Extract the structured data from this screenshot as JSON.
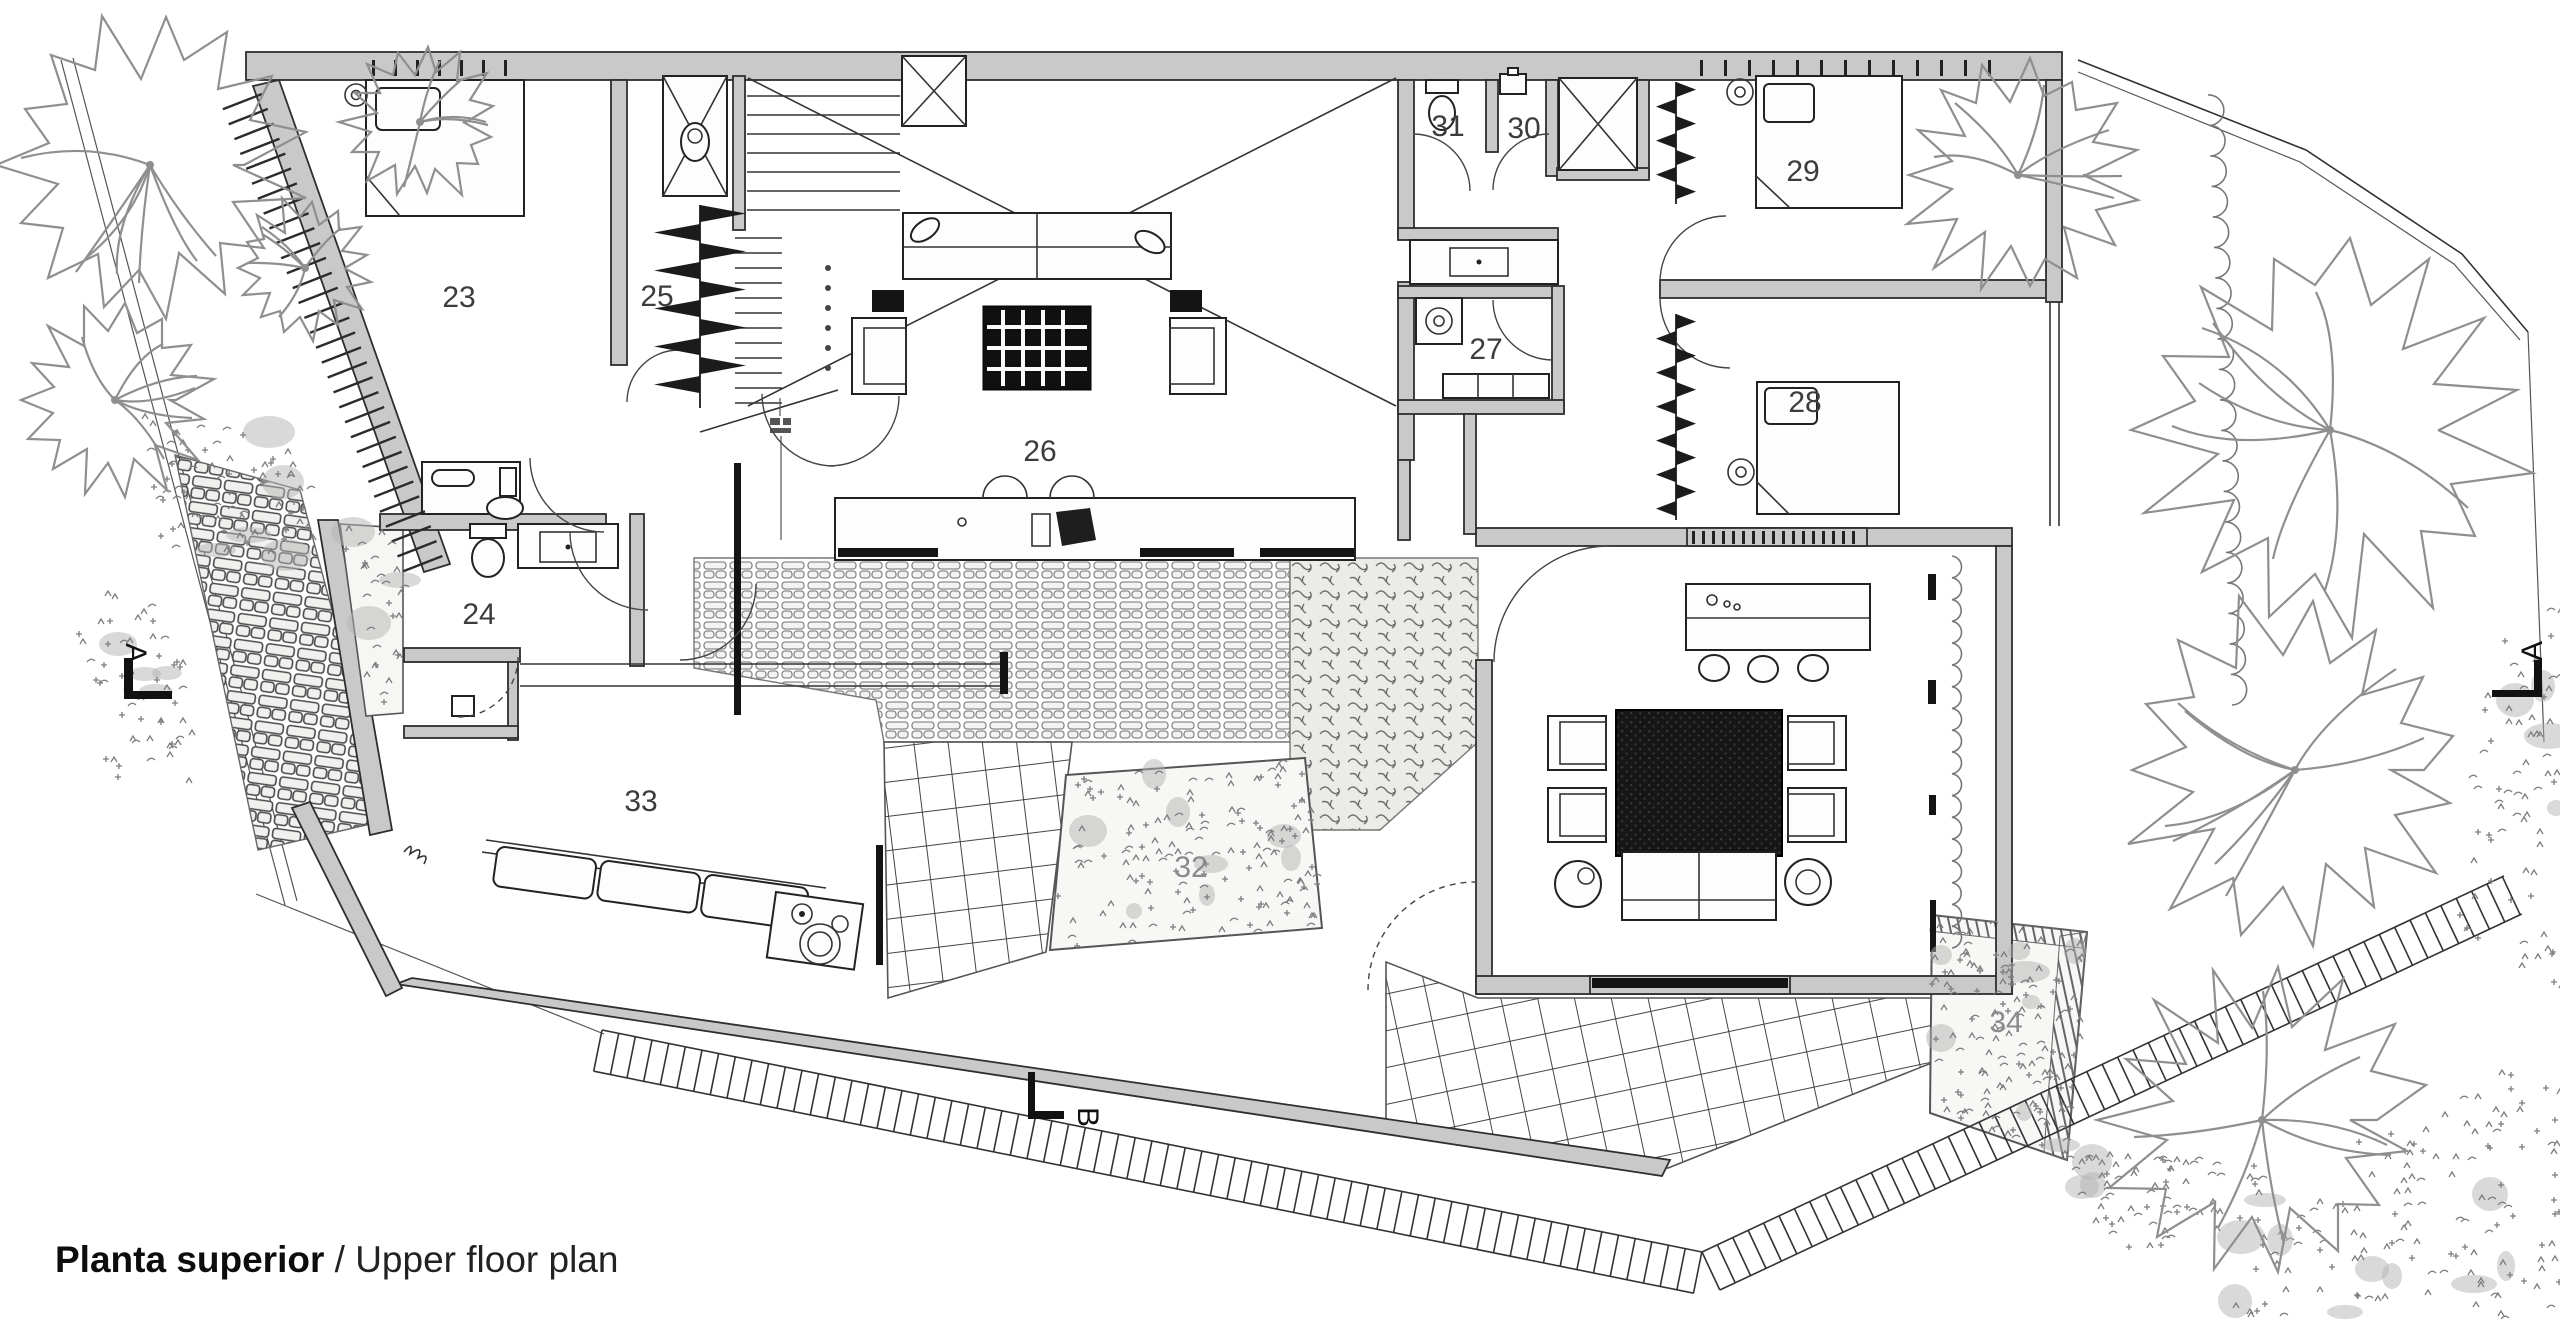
{
  "title": {
    "primary": "Planta superior",
    "separator": " / ",
    "secondary": "Upper floor plan"
  },
  "room_labels": {
    "r23": "23",
    "r24": "24",
    "r25": "25",
    "r26": "26",
    "r27": "27",
    "r28": "28",
    "r29": "29",
    "r30": "30",
    "r31": "31",
    "r32": "32",
    "r33": "33",
    "r34": "34"
  },
  "section_markers": {
    "left": "A",
    "right": "A",
    "bottom": "B"
  },
  "colors": {
    "background": "#ffffff",
    "wall_fill": "#c9c9c9",
    "line": "#1f1f1f",
    "foliage": "#8f8f8f",
    "label": "#3c3c3c",
    "faint_label": "#8a8a8a",
    "dark_furniture": "#141414"
  }
}
